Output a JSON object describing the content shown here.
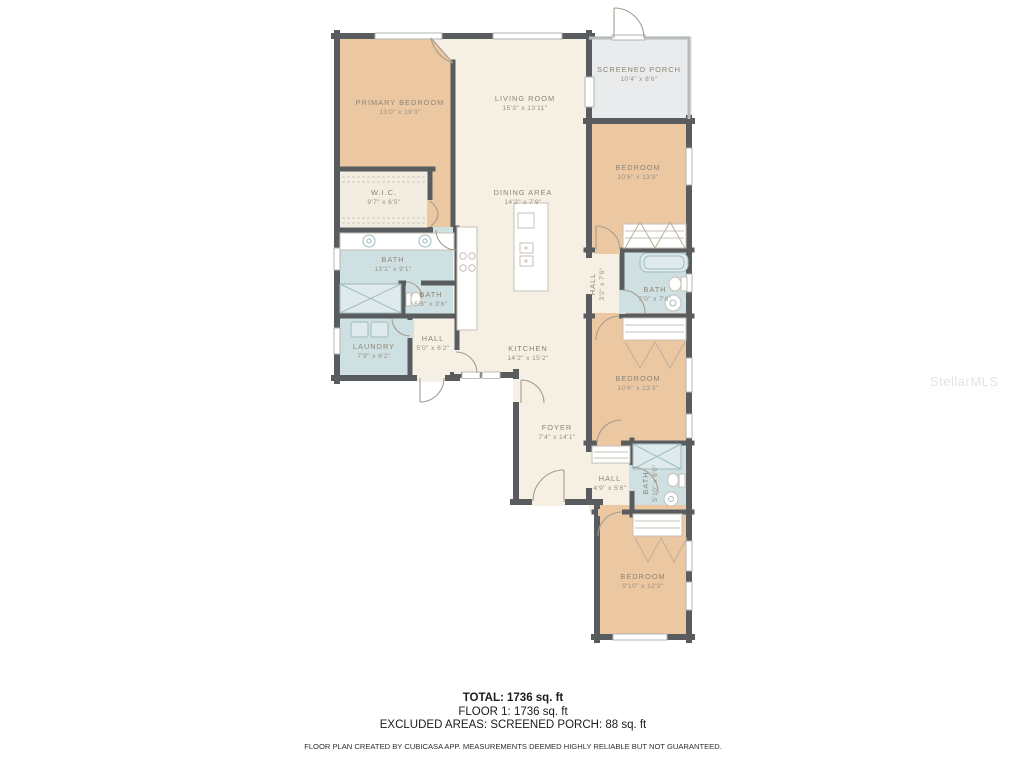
{
  "watermark": "StellarMLS",
  "colors": {
    "bedroom_fill": "#ecc8a2",
    "living_fill": "#f6efe3",
    "bath_fill": "#cfe0e2",
    "porch_fill": "#e9ebec",
    "wall": "#585c5f",
    "label_text": "#8e8476",
    "summary_text": "#1b1b1b"
  },
  "rooms": {
    "primary_bedroom": {
      "name": "PRIMARY BEDROOM",
      "dims": "13'0\" x 19'3\""
    },
    "living_room": {
      "name": "LIVING ROOM",
      "dims": "15'3\" x 13'11\""
    },
    "screened_porch": {
      "name": "SCREENED PORCH",
      "dims": "10'4\" x 8'6\""
    },
    "bedroom_ne": {
      "name": "BEDROOM",
      "dims": "10'6\" x 13'9\""
    },
    "wic": {
      "name": "W.I.C.",
      "dims": "9'7\" x 6'5\""
    },
    "dining_area": {
      "name": "DINING AREA",
      "dims": "14'2\" x 7'9\""
    },
    "bath_primary": {
      "name": "BATH",
      "dims": "13'1\" x 9'1\""
    },
    "bath_small": {
      "name": "BATH",
      "dims": "5'8\" x 3'6\""
    },
    "laundry": {
      "name": "LAUNDRY",
      "dims": "7'9\" x 6'2\""
    },
    "hall_west": {
      "name": "HALL",
      "dims": "5'0\" x 6'2\""
    },
    "kitchen": {
      "name": "KITCHEN",
      "dims": "14'2\" x 15'2\""
    },
    "hall_east": {
      "name": "HALL",
      "dims": "3'2\" x 7'6\""
    },
    "bath_east": {
      "name": "BATH",
      "dims": "7'0\" x 7'6\""
    },
    "bedroom_e": {
      "name": "BEDROOM",
      "dims": "10'6\" x 13'3\""
    },
    "foyer": {
      "name": "FOYER",
      "dims": "7'4\" x 14'1\""
    },
    "hall_south": {
      "name": "HALL",
      "dims": "4'9\" x 5'6\""
    },
    "bath_south": {
      "name": "BATH",
      "dims": "5'10\" x 8'0\""
    },
    "bedroom_se": {
      "name": "BEDROOM",
      "dims": "9'10\" x 12'9\""
    }
  },
  "summary": {
    "total": "TOTAL: 1736 sq. ft",
    "floor1": "FLOOR 1: 1736 sq. ft",
    "excluded": "EXCLUDED AREAS: SCREENED PORCH: 88 sq. ft",
    "disclaimer": "FLOOR PLAN CREATED BY CUBICASA APP. MEASUREMENTS DEEMED HIGHLY RELIABLE BUT NOT GUARANTEED."
  }
}
